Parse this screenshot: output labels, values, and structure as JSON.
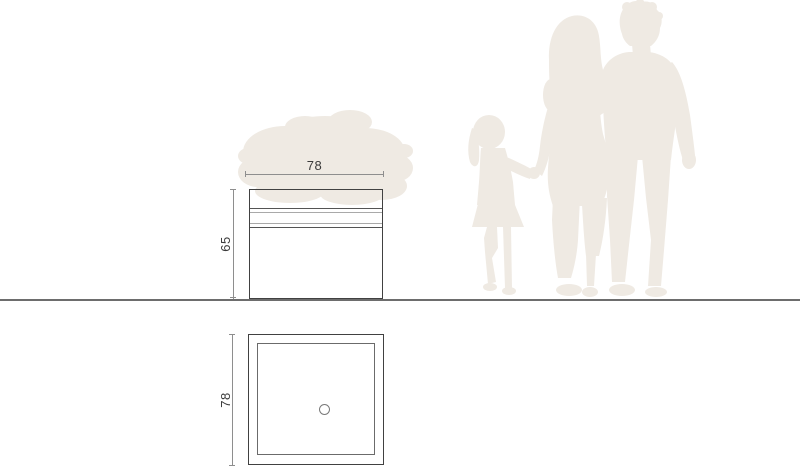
{
  "diagram": {
    "type": "furniture-dimension-drawing",
    "views": {
      "front_elevation": {
        "description": "planter cube with foliage, front view",
        "width_label": "78",
        "height_label": "65"
      },
      "plan": {
        "description": "top view with inner rim and central drain hole",
        "width_label": "78"
      }
    },
    "scale_reference": {
      "figures": [
        "child",
        "woman",
        "man"
      ],
      "decor": [
        "plant-foliage"
      ]
    },
    "colors": {
      "outline": "#414141",
      "dimension_line": "#8e8e8e",
      "ground_line": "#6d6d6d",
      "silhouette": "#efeae3",
      "label_text": "#3a3a3a",
      "background": "#ffffff"
    }
  }
}
